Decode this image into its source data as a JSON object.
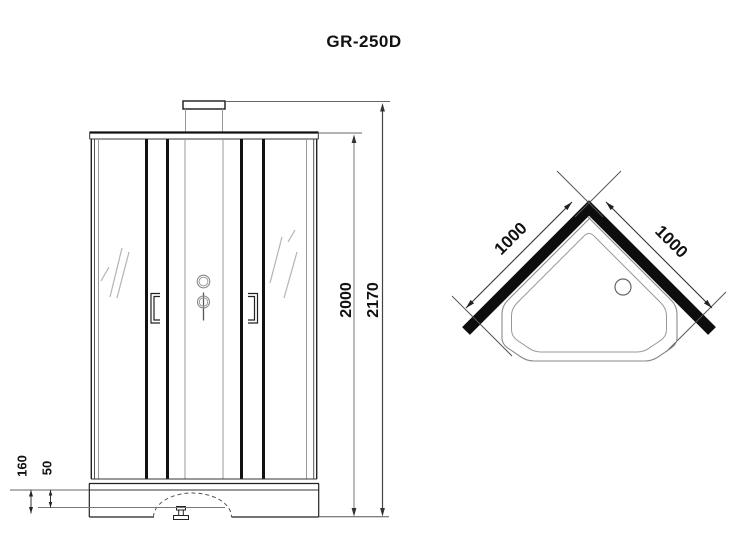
{
  "title": "GR-250D",
  "colors": {
    "line": "#1a1a1a",
    "gray_line": "#999999",
    "background": "#ffffff"
  },
  "front_view": {
    "dim_inner_height": "2000",
    "dim_total_height": "2170",
    "dim_tray_height": "160",
    "dim_tray_step": "50"
  },
  "top_view": {
    "dim_side_left": "1000",
    "dim_side_right": "1000"
  }
}
